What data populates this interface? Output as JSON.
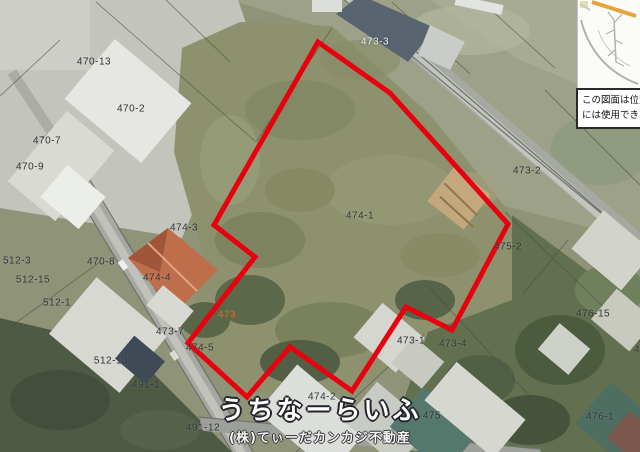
{
  "map": {
    "boundary": {
      "color": "#e8000f",
      "stroke_width": 5,
      "points": [
        [
          318,
          42
        ],
        [
          390,
          93
        ],
        [
          508,
          224
        ],
        [
          452,
          330
        ],
        [
          406,
          307
        ],
        [
          352,
          391
        ],
        [
          290,
          347
        ],
        [
          247,
          397
        ],
        [
          188,
          343
        ],
        [
          255,
          257
        ],
        [
          214,
          225
        ]
      ]
    },
    "parcel_labels": [
      {
        "text": "473-3",
        "x": 375,
        "y": 42,
        "color": "white"
      },
      {
        "text": "470-13",
        "x": 94,
        "y": 62,
        "color": "dark"
      },
      {
        "text": "470-2",
        "x": 131,
        "y": 109,
        "color": "dark"
      },
      {
        "text": "470-7",
        "x": 47,
        "y": 141,
        "color": "dark"
      },
      {
        "text": "470-9",
        "x": 30,
        "y": 167,
        "color": "dark"
      },
      {
        "text": "473-2",
        "x": 527,
        "y": 171,
        "color": "dark"
      },
      {
        "text": "474-1",
        "x": 360,
        "y": 216,
        "color": "dark"
      },
      {
        "text": "474-3",
        "x": 184,
        "y": 228,
        "color": "dark"
      },
      {
        "text": "475-2",
        "x": 508,
        "y": 247,
        "color": "dark"
      },
      {
        "text": "512-3",
        "x": 17,
        "y": 261,
        "color": "dark"
      },
      {
        "text": "470-8",
        "x": 101,
        "y": 262,
        "color": "dark"
      },
      {
        "text": "512-15",
        "x": 33,
        "y": 280,
        "color": "dark"
      },
      {
        "text": "474-4",
        "x": 157,
        "y": 278,
        "color": "dark"
      },
      {
        "text": "512-1",
        "x": 57,
        "y": 303,
        "color": "dark"
      },
      {
        "text": "473",
        "x": 227,
        "y": 315,
        "color": "orange"
      },
      {
        "text": "476-15",
        "x": 593,
        "y": 314,
        "color": "dark"
      },
      {
        "text": "473-7",
        "x": 170,
        "y": 332,
        "color": "dark"
      },
      {
        "text": "474-5",
        "x": 200,
        "y": 348,
        "color": "dark"
      },
      {
        "text": "473-1",
        "x": 411,
        "y": 341,
        "color": "dark"
      },
      {
        "text": "473-4",
        "x": 453,
        "y": 344,
        "color": "dark"
      },
      {
        "text": "512-13",
        "x": 111,
        "y": 361,
        "color": "dark"
      },
      {
        "text": "491-1",
        "x": 146,
        "y": 385,
        "color": "dark"
      },
      {
        "text": "474-2",
        "x": 322,
        "y": 397,
        "color": "dark"
      },
      {
        "text": "491-12",
        "x": 203,
        "y": 428,
        "color": "dark"
      },
      {
        "text": "475",
        "x": 432,
        "y": 416,
        "color": "dark"
      },
      {
        "text": "476-1",
        "x": 600,
        "y": 417,
        "color": "dark"
      },
      {
        "text": "4",
        "x": 637,
        "y": 350,
        "color": "dark"
      }
    ],
    "watermark": {
      "title": "うちなーらいふ",
      "subtitle": "(株)てぃーだカンカジ不動産"
    },
    "inset": {
      "disclaimer_line1": "この図面は位置",
      "disclaimer_line2": "には使用できま"
    }
  }
}
